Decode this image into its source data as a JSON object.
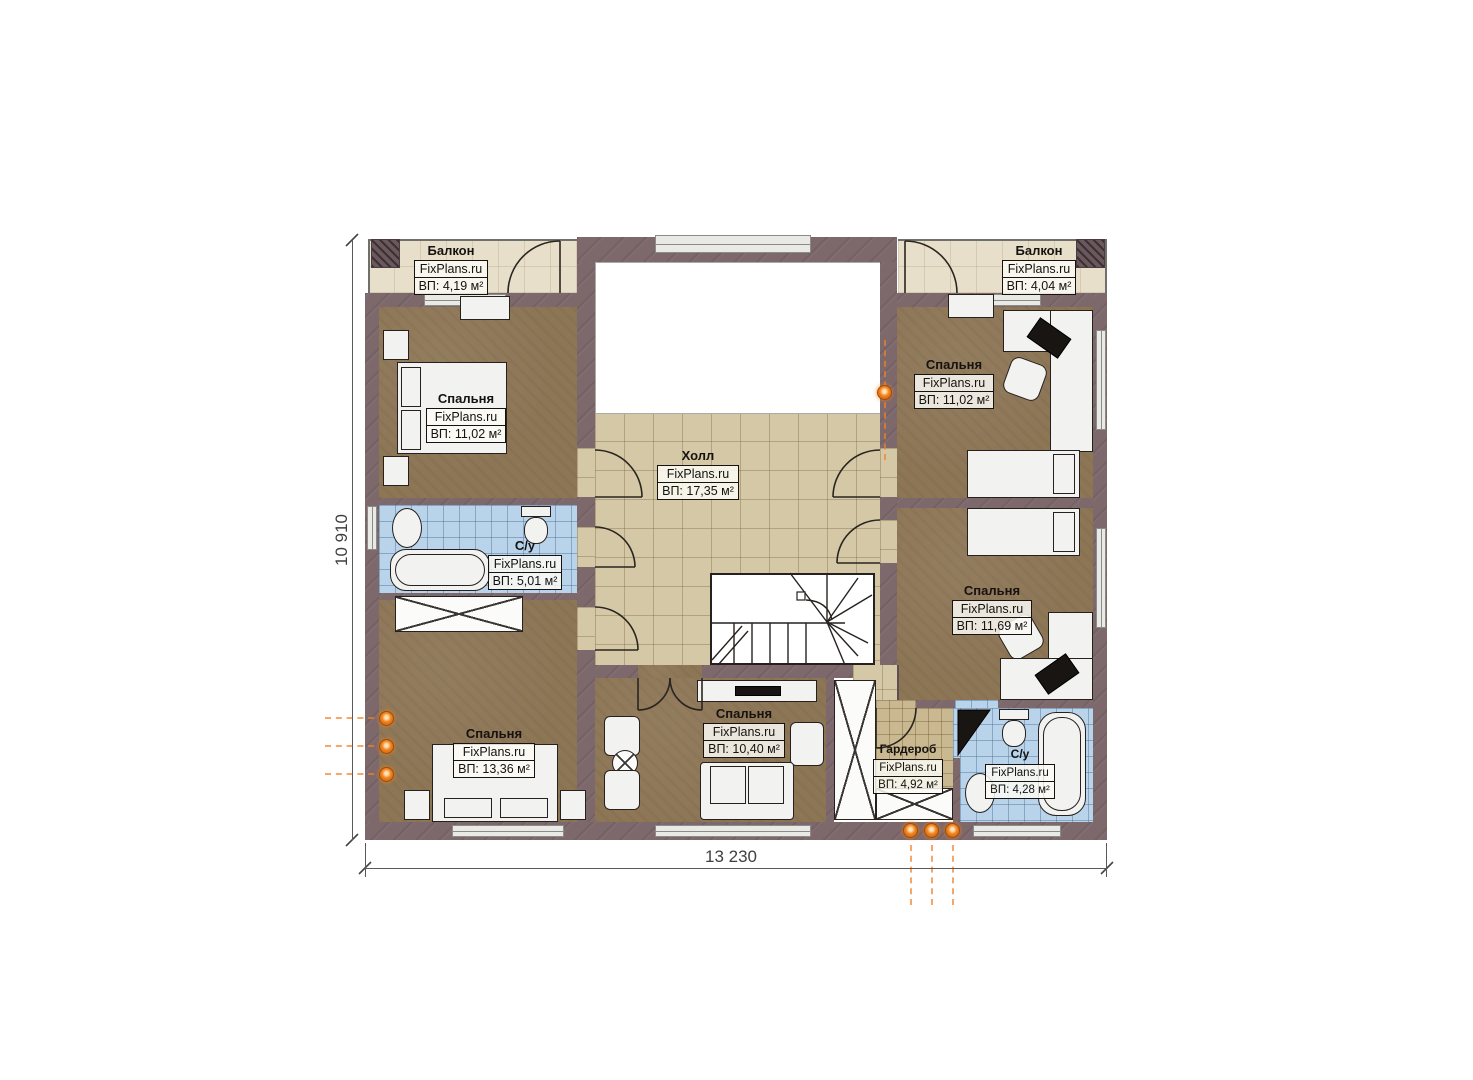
{
  "brand": "FixPlans.ru",
  "dimensions": {
    "width": "13 230",
    "height": "10 910"
  },
  "rooms": [
    {
      "key": "balcony_left",
      "name": "Балкон",
      "area": "ВП: 4,19 м²"
    },
    {
      "key": "balcony_right",
      "name": "Балкон",
      "area": "ВП: 4,04 м²"
    },
    {
      "key": "bedroom_top_left",
      "name": "Спальня",
      "area": "ВП: 11,02 м²"
    },
    {
      "key": "bedroom_top_right",
      "name": "Спальня",
      "area": "ВП: 11,02 м²"
    },
    {
      "key": "hall",
      "name": "Холл",
      "area": "ВП: 17,35 м²"
    },
    {
      "key": "bathroom_left",
      "name": "С/у",
      "area": "ВП: 5,01 м²"
    },
    {
      "key": "bedroom_mid_right",
      "name": "Спальня",
      "area": "ВП: 11,69 м²"
    },
    {
      "key": "bedroom_bottom_left",
      "name": "Спальня",
      "area": "ВП: 13,36 м²"
    },
    {
      "key": "bedroom_bottom_center",
      "name": "Спальня",
      "area": "ВП: 10,40 м²"
    },
    {
      "key": "wardrobe",
      "name": "Гардероб",
      "area": "ВП: 4,92 м²"
    },
    {
      "key": "bathroom_right",
      "name": "С/у",
      "area": "ВП: 4,28 м²"
    }
  ],
  "colors": {
    "wall": "#7d686c",
    "bedroom_floor": "#8d7656",
    "hall_floor": "#d5c8a6",
    "balcony_floor": "#e8dfca",
    "bathroom_floor": "#b9d4ea",
    "wardrobe_floor": "#c9b890",
    "accent_orange": "#f1841f"
  }
}
